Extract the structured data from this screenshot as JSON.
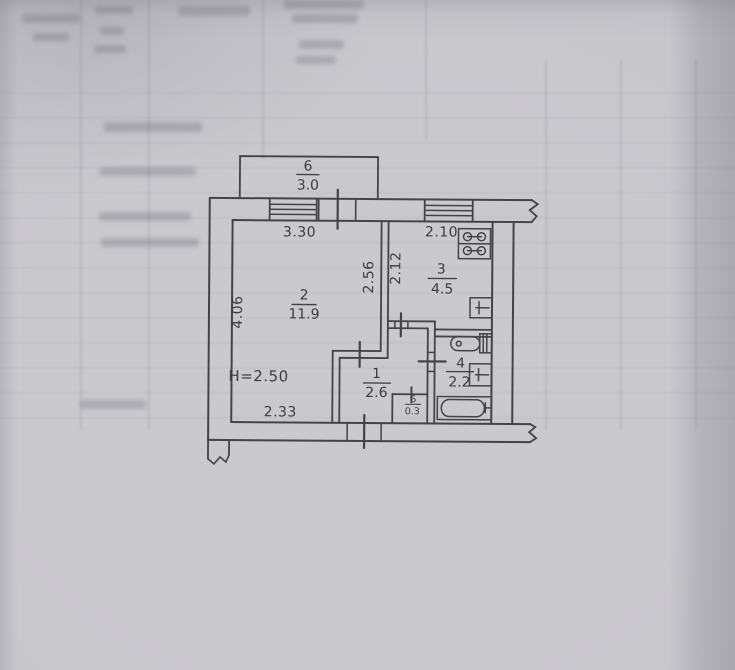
{
  "page": {
    "description": "Photograph of an apartment floor plan drawn on gray paper with faint table bleed-through"
  },
  "plan": {
    "ceiling_height_label": "H=2.50",
    "rooms": [
      {
        "number": "6",
        "area": "3.0",
        "name": "balcony"
      },
      {
        "number": "2",
        "area": "11.9",
        "name": "living room"
      },
      {
        "number": "3",
        "area": "4.5",
        "name": "kitchen"
      },
      {
        "number": "1",
        "area": "2.6",
        "name": "hallway"
      },
      {
        "number": "4",
        "area": "2.2",
        "name": "bathroom"
      },
      {
        "number": "5",
        "area": "0.3",
        "name": "closet"
      }
    ],
    "dimensions": {
      "room2_top_width": "3.30",
      "kitchen_top_width": "2.10",
      "room2_left_height": "4.06",
      "room2_right_height": "2.56",
      "kitchen_left_height": "2.12",
      "room2_bottom_width": "2.33"
    },
    "fixtures": [
      "stove",
      "kitchen sink",
      "toilet",
      "washbasin",
      "bathtub"
    ],
    "colors": {
      "ink": "#403f45",
      "paper": "#c7c6cb"
    }
  }
}
